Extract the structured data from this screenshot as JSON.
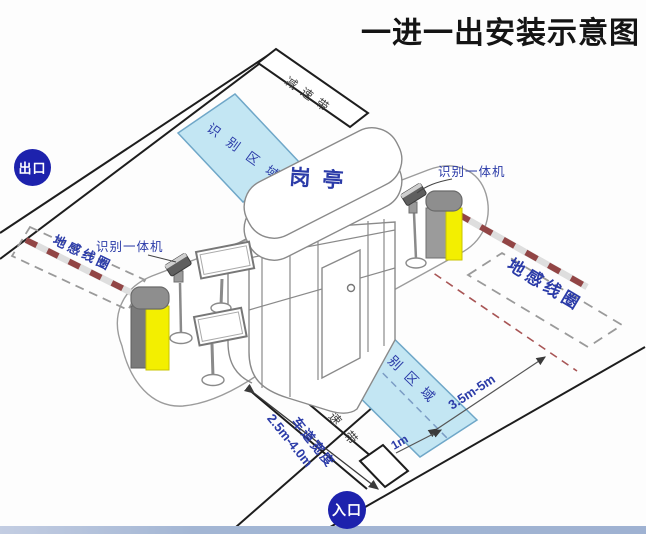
{
  "title": "一进一出安装示意图",
  "booth": {
    "label": "岗亭"
  },
  "exit_lane": {
    "badge": "出口",
    "speed_bump": "减速带",
    "recognition_zone": "识别区域",
    "ground_loop": "地感线圈",
    "camera_label": "识别一体机"
  },
  "entrance_lane": {
    "badge": "入口",
    "speed_bump": "减速带",
    "recognition_zone": "识别区域",
    "ground_loop": "地感线圈",
    "camera_label": "识别一体机",
    "dimensions": {
      "loop_distance": "3.5m-5m",
      "zone_offset": "1m",
      "lane_width_label": "车道宽度",
      "lane_width_value": "2.5m-4.0m"
    }
  },
  "colors": {
    "label_blue": "#2b3ba8",
    "badge_blue": "#1d22ad",
    "zone_fill": "#c3e6f3",
    "barrier_arm_red": "#9a3333",
    "barrier_body_yellow": "#f3ef00",
    "line_black": "#1d1d1d"
  }
}
